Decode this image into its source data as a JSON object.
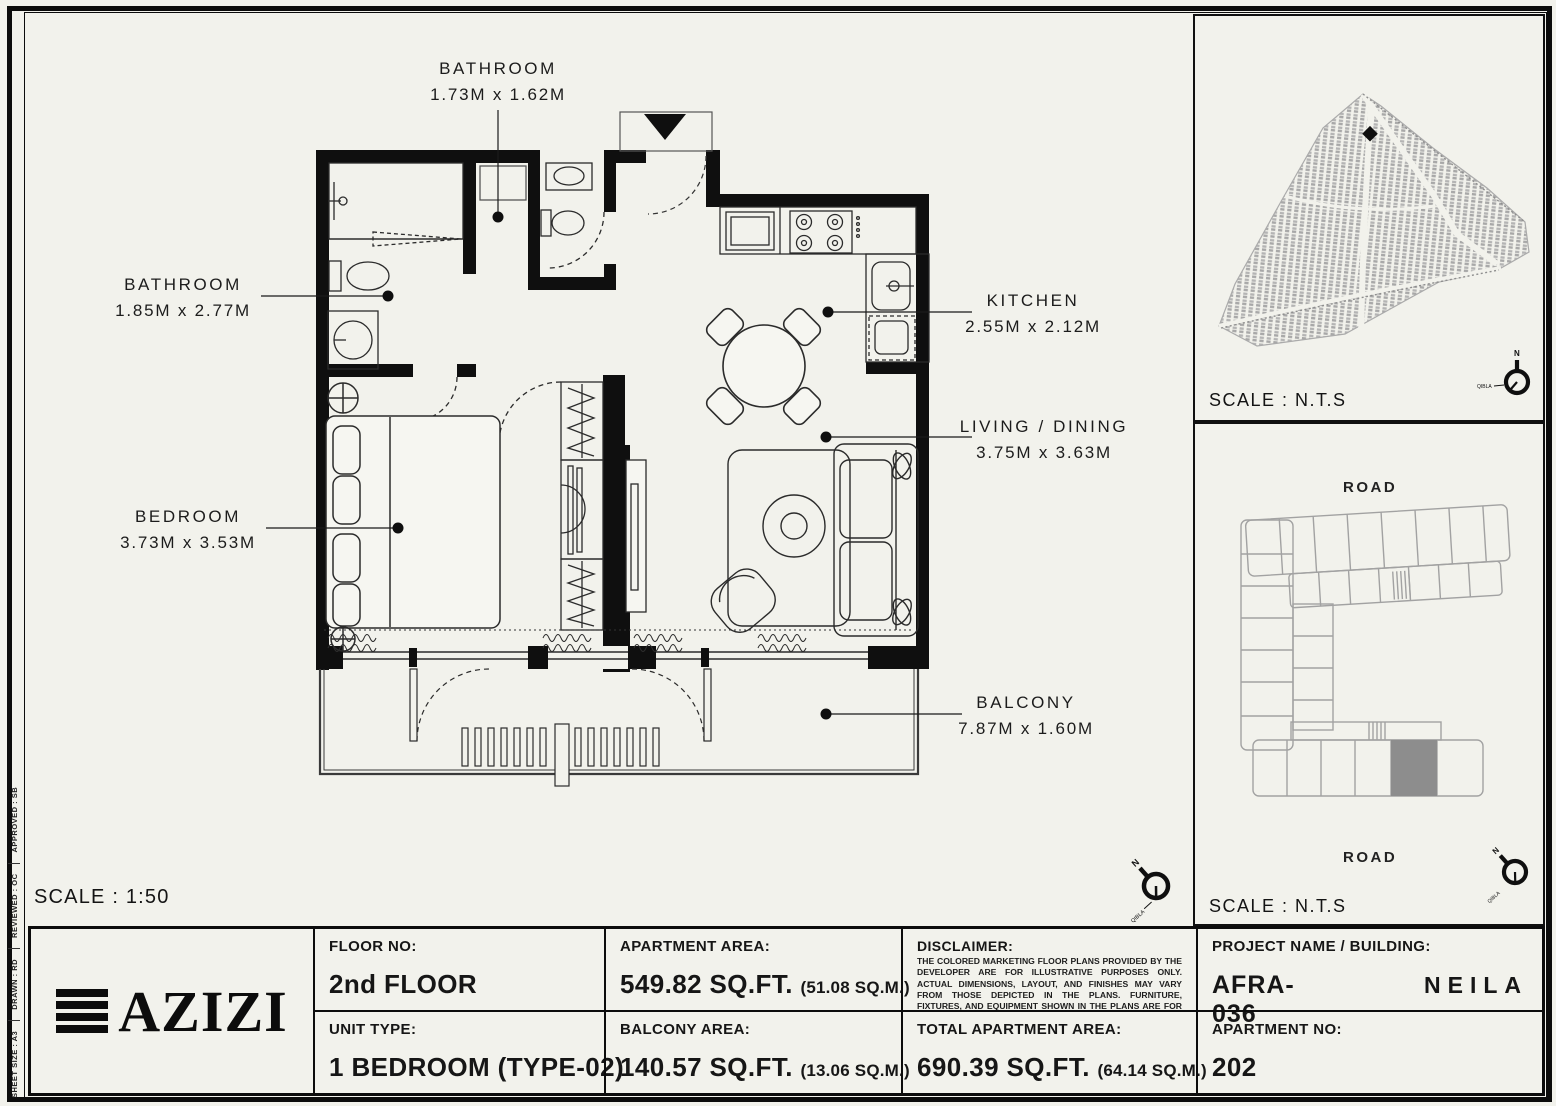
{
  "sheet": {
    "scale_main": "SCALE : 1:50",
    "margin_notes": [
      "SHEET SIZE : A3",
      "DRAWN : RD",
      "REVIEWED : OC",
      "APPROVED : SB"
    ]
  },
  "compass": {
    "north": "N",
    "qibla": "QIBLA"
  },
  "floor_plan": {
    "rooms": [
      {
        "name": "BATHROOM",
        "dims": "1.73M x 1.62M"
      },
      {
        "name": "BATHROOM",
        "dims": "1.85M x 2.77M"
      },
      {
        "name": "BEDROOM",
        "dims": "3.73M x 3.53M"
      },
      {
        "name": "KITCHEN",
        "dims": "2.55M x 2.12M"
      },
      {
        "name": "LIVING / DINING",
        "dims": "3.75M x 3.63M"
      },
      {
        "name": "BALCONY",
        "dims": "7.87M x 1.60M"
      }
    ]
  },
  "site_map": {
    "scale": "SCALE : N.T.S"
  },
  "key_plan": {
    "scale": "SCALE : N.T.S",
    "road_top": "ROAD",
    "road_bottom": "ROAD"
  },
  "title_block": {
    "brand": "AZIZI",
    "floor_no_label": "FLOOR NO:",
    "floor_no": "2nd FLOOR",
    "unit_type_label": "UNIT TYPE:",
    "unit_type": "1 BEDROOM (TYPE-02)",
    "apartment_area_label": "APARTMENT AREA:",
    "apartment_area": "549.82 SQ.FT.",
    "apartment_area_m": "(51.08 SQ.M.)",
    "balcony_area_label": "BALCONY AREA:",
    "balcony_area": "140.57 SQ.FT.",
    "balcony_area_m": "(13.06 SQ.M.)",
    "disclaimer_label": "DISCLAIMER:",
    "disclaimer_text": "THE COLORED MARKETING FLOOR PLANS PROVIDED BY THE DEVELOPER ARE FOR ILLUSTRATIVE PURPOSES ONLY. ACTUAL DIMENSIONS, LAYOUT, AND FINISHES MAY VARY FROM THOSE DEPICTED IN THE PLANS. FURNITURE, FIXTURES, AND EQUIPMENT SHOWN IN THE PLANS ARE FOR DECORATIVE PURPOSES ONLY AND ARE NOT INCLUDED IN THE PURCHASE OR LEASE OF THE PROPERTY. THE DEVELOPER RESERVES THE RIGHT TO MAKE MODIFICATIONS, REVISIONS, AND CHANGES TO THE FLOOR PLANS, SPECIFICATIONS, AND FEATURES WITHOUT PRIOR NOTICE.",
    "total_area_label": "TOTAL APARTMENT AREA:",
    "total_area": "690.39 SQ.FT.",
    "total_area_m": "(64.14 SQ.M.)",
    "project_label": "PROJECT NAME / BUILDING:",
    "project_name": "AFRA-036",
    "building_name": "NEILA",
    "apartment_no_label": "APARTMENT NO:",
    "apartment_no": "202"
  }
}
